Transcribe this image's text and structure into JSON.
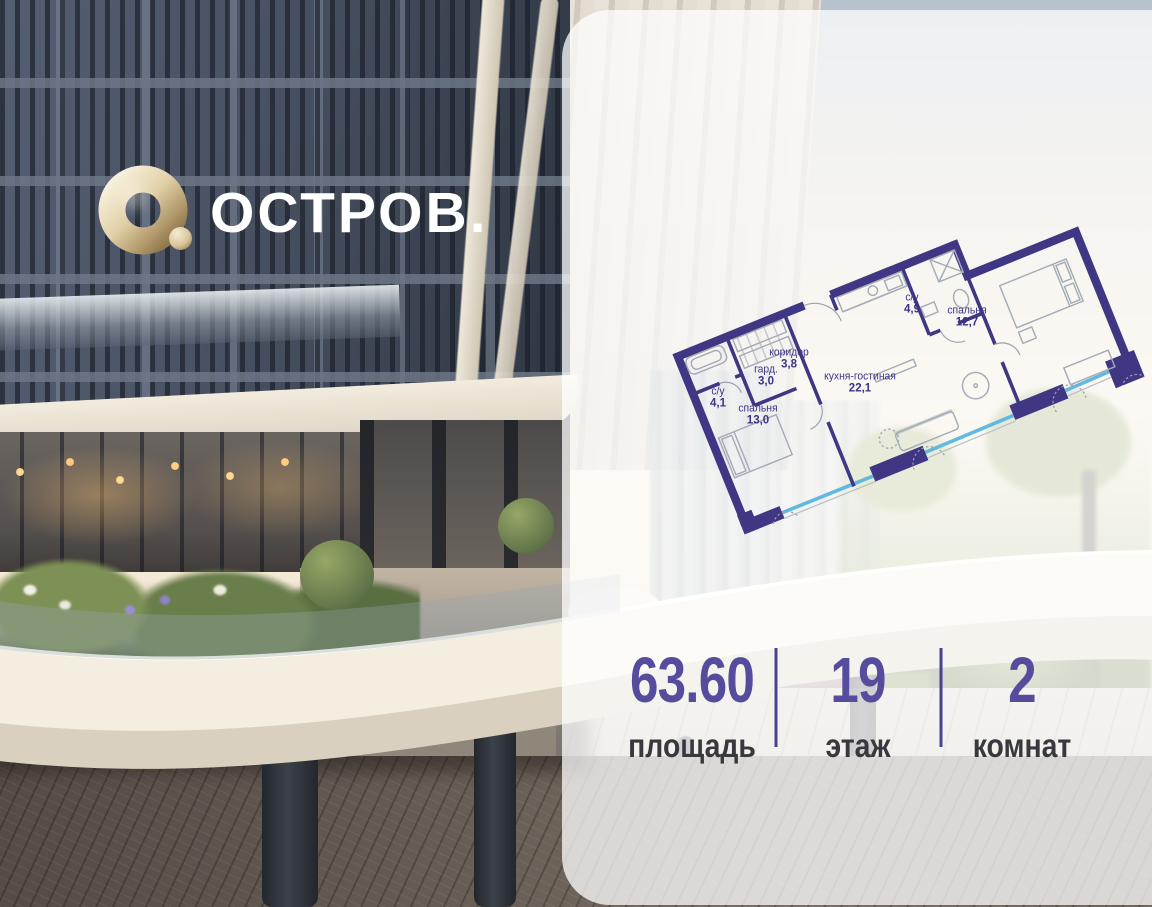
{
  "brand": {
    "title": "ОСТРОВ.",
    "logo_icon": "gold-torus-icon"
  },
  "panel": {
    "floor_plan": {
      "rooms": [
        {
          "name": "с/у",
          "area": "4,9"
        },
        {
          "name": "спальня",
          "area": "12,7"
        },
        {
          "name": "коридор",
          "area": "3,8"
        },
        {
          "name": "гард.",
          "area": "3,0"
        },
        {
          "name": "кухня-гостиная",
          "area": "22,1"
        },
        {
          "name": "с/у",
          "area": "4,1"
        },
        {
          "name": "спальня",
          "area": "13,0"
        }
      ],
      "total_area": "63,6"
    },
    "stats": [
      {
        "value": "63.60",
        "label": "площадь"
      },
      {
        "value": "19",
        "label": "этаж"
      },
      {
        "value": "2",
        "label": "комнат"
      }
    ]
  },
  "colors": {
    "accent_purple": "#4a4192",
    "plan_wall_purple": "#3f3684",
    "window_blue": "#62b9e0",
    "logo_gold": "#cbb286",
    "panel_white": "rgba(255,255,255,0.74)"
  }
}
